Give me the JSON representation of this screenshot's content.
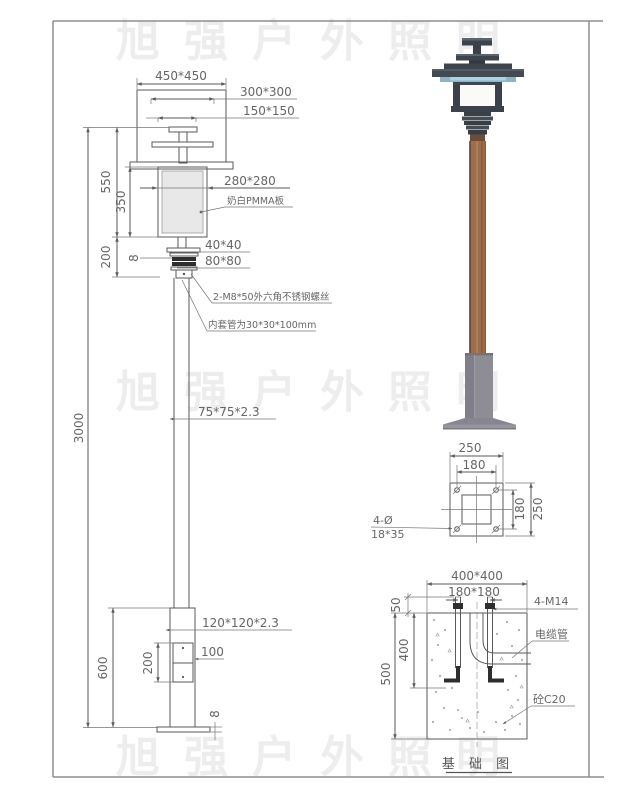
{
  "watermark": {
    "text": "旭强户外照明",
    "color": "#ededed"
  },
  "elevation": {
    "dim_450": "450*450",
    "dim_300": "300*300",
    "dim_150": "150*150",
    "dim_550": "550",
    "dim_350": "350",
    "dim_280": "280*280",
    "note_pmma": "奶白PMMA板",
    "dim_200_neck": "200",
    "dim_40": "40*40",
    "dim_80": "80*80",
    "dim_ring_8": "8",
    "note_screw": "2-M8*50外六角不锈钢螺丝",
    "note_sleeve": "内套管为30*30*100mm",
    "dim_3000": "3000",
    "dim_pole": "75*75*2.3",
    "dim_base_tube": "120*120*2.3",
    "dim_600": "600",
    "dim_door_h": "200",
    "dim_door_w": "100",
    "dim_plate_8": "8"
  },
  "base_plate": {
    "dim_250_top": "250",
    "dim_180_top": "180",
    "dim_180_right": "180",
    "dim_250_right": "250",
    "note_holes_line1": "4-Ø",
    "note_holes_line2": "18*35"
  },
  "foundation": {
    "dim_400x400": "400*400",
    "dim_180x180": "180*180",
    "note_bolts": "4-M14",
    "dim_50": "50",
    "dim_400": "400",
    "dim_500": "500",
    "note_cable": "电缆管",
    "note_concrete": "砼C20",
    "caption": "基 础 图"
  }
}
